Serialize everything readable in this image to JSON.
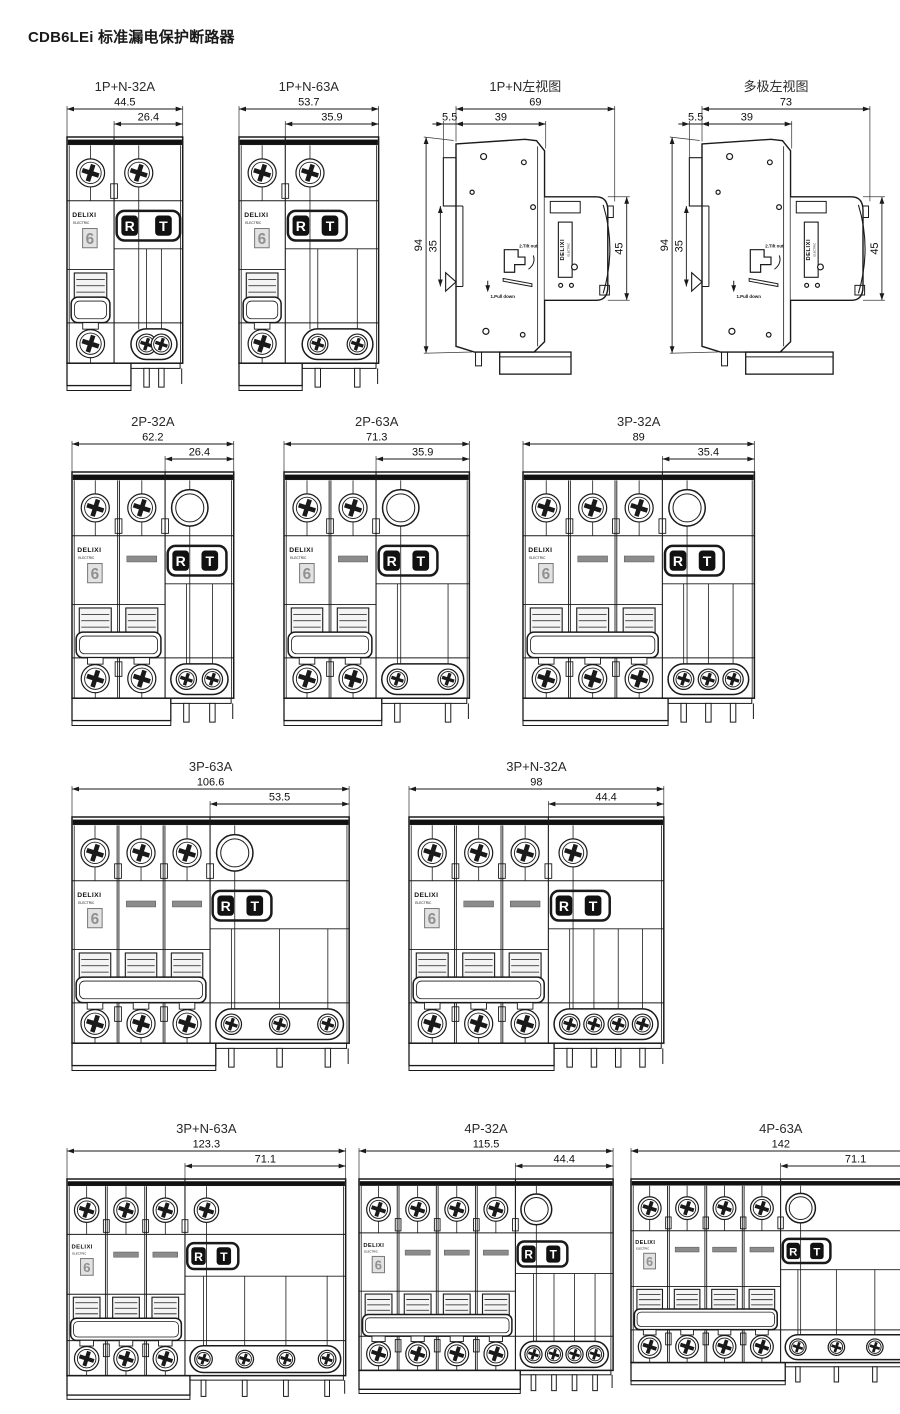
{
  "page": {
    "title": "CDB6LEi 标准漏电保护断路器",
    "colors": {
      "line": "#1a1a1a",
      "dark": "#111111",
      "gray_bar": "#8c8c8c",
      "light_gray": "#e2e2e2",
      "dim_text": "#111111"
    }
  },
  "shared": {
    "brand": "DELIXI",
    "brand_sub": "ELECTRIC",
    "rating": "6",
    "reset_label": "R",
    "test_label": "T"
  },
  "figures": [
    {
      "label": "1P+N-32A",
      "view": "front",
      "overall_dim": "44.5",
      "module_dim": "26.4",
      "poles": 1,
      "top_right": "screw",
      "bottom_screws": 2
    },
    {
      "label": "1P+N-63A",
      "view": "front",
      "overall_dim": "53.7",
      "module_dim": "35.9",
      "poles": 1,
      "top_right": "screw",
      "bottom_screws": 2
    },
    {
      "label": "1P+N左视图",
      "view": "side",
      "variant": "single",
      "dims": {
        "overall": "69",
        "rail_offset": "5.5",
        "body_depth": "39",
        "height": "94",
        "slot": "35",
        "head": "45"
      },
      "annotations": {
        "step2": "2.Tilt out",
        "step1": "1.Pull down"
      }
    },
    {
      "label": "多极左视图",
      "view": "side",
      "variant": "multi",
      "dims": {
        "overall": "73",
        "rail_offset": "5.5",
        "body_depth": "39",
        "height": "94",
        "slot": "35",
        "head": "45"
      },
      "annotations": {
        "step2": "2.Tilt out",
        "step1": "1.Pull down"
      }
    },
    {
      "label": "2P-32A",
      "view": "front",
      "overall_dim": "62.2",
      "module_dim": "26.4",
      "poles": 2,
      "top_right": "hole",
      "bottom_screws": 2
    },
    {
      "label": "2P-63A",
      "view": "front",
      "overall_dim": "71.3",
      "module_dim": "35.9",
      "poles": 2,
      "top_right": "hole",
      "bottom_screws": 2
    },
    {
      "label": "3P-32A",
      "view": "front",
      "overall_dim": "89",
      "module_dim": "35.4",
      "poles": 3,
      "top_right": "hole",
      "bottom_screws": 3
    },
    {
      "label": "3P-63A",
      "view": "front",
      "overall_dim": "106.6",
      "module_dim": "53.5",
      "poles": 3,
      "top_right": "hole",
      "bottom_screws": 3
    },
    {
      "label": "3P+N-32A",
      "view": "front",
      "overall_dim": "98",
      "module_dim": "44.4",
      "poles": 3,
      "top_right": "screw",
      "bottom_screws": 4
    },
    {
      "label": "3P+N-63A",
      "view": "front",
      "overall_dim": "123.3",
      "module_dim": "71.1",
      "poles": 3,
      "top_right": "screw",
      "bottom_screws": 4
    },
    {
      "label": "4P-32A",
      "view": "front",
      "overall_dim": "115.5",
      "module_dim": "44.4",
      "poles": 4,
      "top_right": "hole",
      "bottom_screws": 4
    },
    {
      "label": "4P-63A",
      "view": "front",
      "overall_dim": "142",
      "module_dim": "71.1",
      "poles": 4,
      "top_right": "hole",
      "bottom_screws": 4
    }
  ]
}
